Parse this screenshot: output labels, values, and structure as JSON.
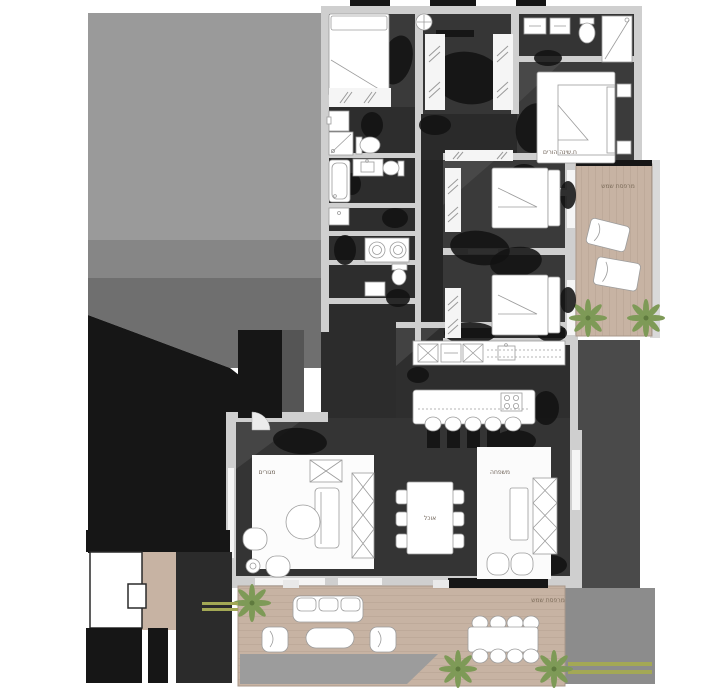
{
  "plan": {
    "kind": "apartment-floor-plan",
    "labels": {
      "master_bedroom": "ח.שינה הורים",
      "balcony_top": "מרפסת שמש",
      "balcony_bottom": "מרפסת שמש",
      "living": "מגורים",
      "family": "משפחה",
      "dining": "אוכל"
    }
  },
  "colors": {
    "background": "#ffffff",
    "neighbor_gray": "#9a9a9a",
    "neighbor_gray_dark": "#868686",
    "neighbor_gray_mid": "#6f6f6f",
    "shadow_black": "#121212",
    "floor_dark": "#353535",
    "floor_darker": "#282828",
    "wall_light": "#cfcfcf",
    "wall_white": "#f5f5f5",
    "furniture_white": "#ffffff",
    "furniture_stroke": "#9c9c9c",
    "wood_deck": "#c7b3a3",
    "wood_plank": "#b5a191",
    "plant_green": "#7e9a57",
    "hedge_olive": "#a3a855",
    "label_color": "#6e6257"
  }
}
